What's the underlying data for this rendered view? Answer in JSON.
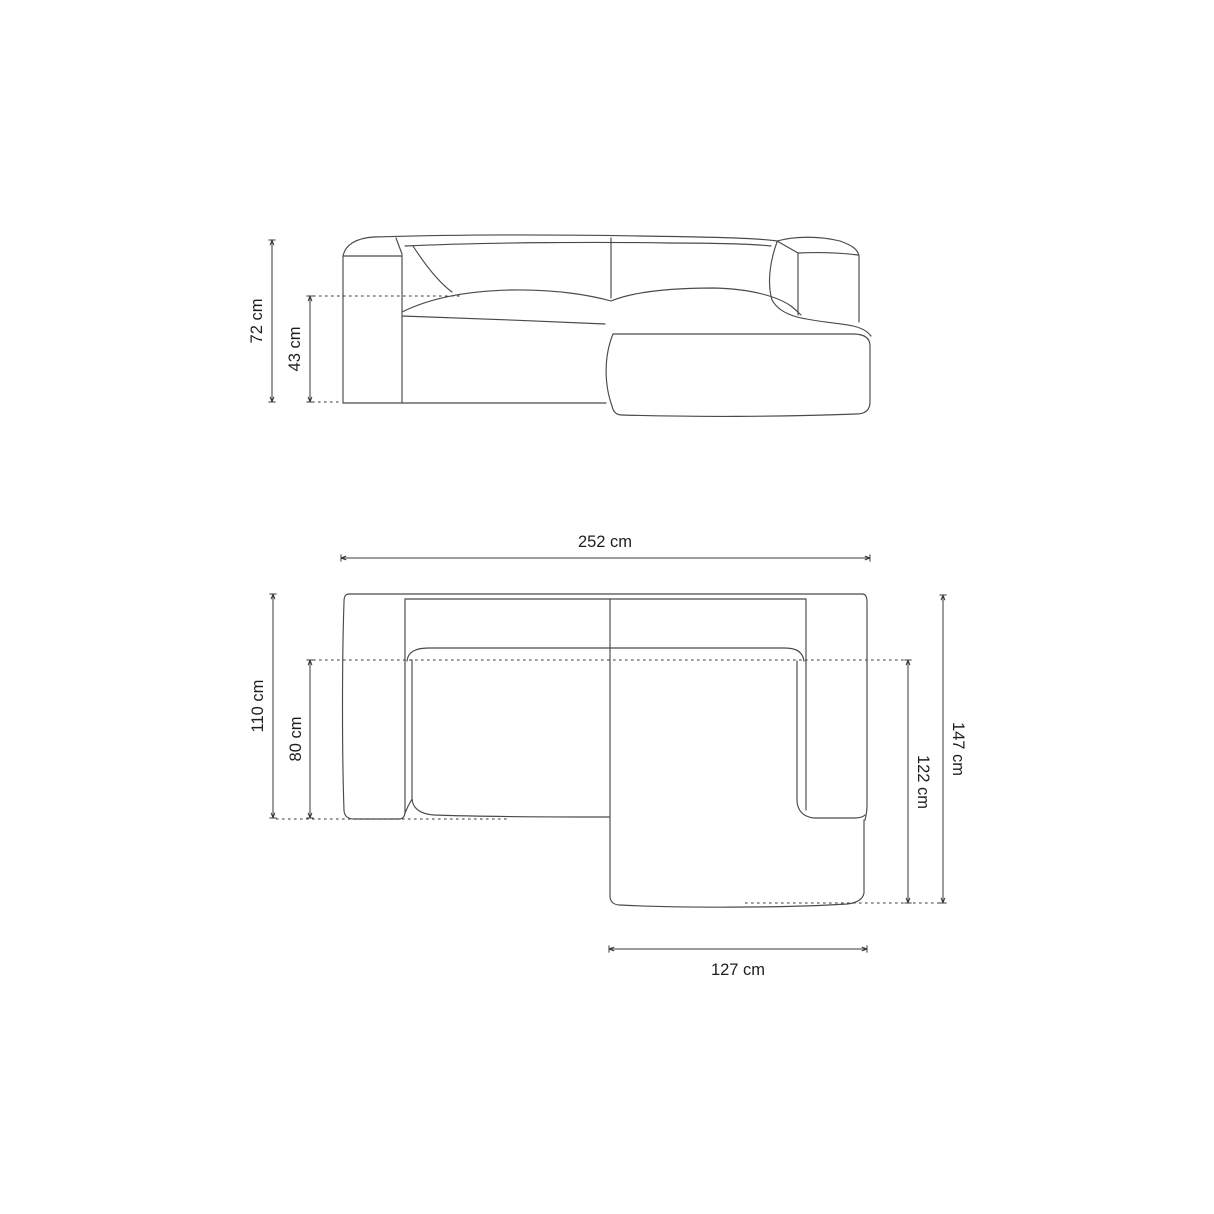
{
  "front_view": {
    "overall_height": "72 cm",
    "seat_height": "43 cm"
  },
  "plan_view": {
    "overall_width": "252 cm",
    "side_depth": "110 cm",
    "seat_depth": "80 cm",
    "total_depth": "147 cm",
    "chaise_depth": "122 cm",
    "chaise_width": "127 cm"
  },
  "colors": {
    "bg": "#ffffff",
    "outline": "#4a4a4a",
    "dim": "#383838",
    "text": "#1e1e1e"
  }
}
